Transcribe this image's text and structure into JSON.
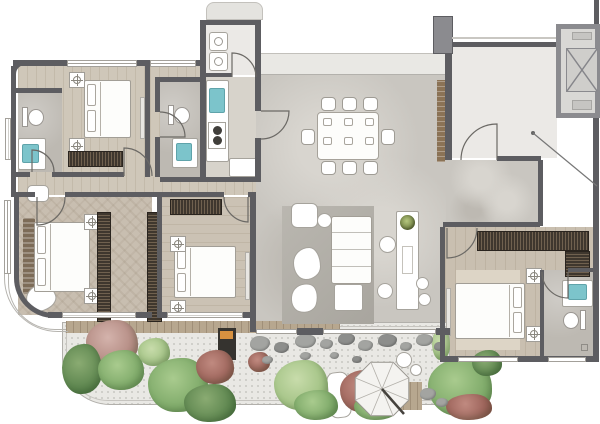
{
  "meta": {
    "title": "Apartment floor plan rendering",
    "canvas_w": 600,
    "canvas_h": 424
  },
  "palette": {
    "wall": "#5d5d61",
    "wallMid": "#8b8b8f",
    "outline": "#a5a29b",
    "marble": "#c9c6c0",
    "marbleLight": "#d8d5cf",
    "bath": "#bdb9b2",
    "lobby": "#ebe9e6",
    "band": "#e9e8e4",
    "wood": "#cfc7b9",
    "woodV": "#cbc2b4",
    "herringbone": "#c8beb0",
    "woodBed4": "#c9bfb0",
    "deck": "#b7a78f",
    "gravel": "#e9e8e4",
    "rug": "#b3b0a9",
    "rugBeige": "#ddd5c6",
    "white": "#ffffff",
    "blue": "#7cc4cb",
    "orange": "#d79140",
    "bbq": "#35332f",
    "wardrobe": "#3f372e",
    "wardrobeSlat": "#70614f",
    "headboard": "#7d6c58",
    "brick": "#8b7356",
    "stone": "#a3a4a1",
    "stoneDark": "#8d8e8c"
  },
  "treeColors": {
    "green": [
      "#a9cb8e",
      "#6f9e5c"
    ],
    "greenL": [
      "#c8dcab",
      "#95b977"
    ],
    "greenD": [
      "#8aab72",
      "#4f7a44"
    ],
    "red": [
      "#c08a80",
      "#91574e"
    ],
    "pink": [
      "#d4b3ac",
      "#a87d74"
    ]
  },
  "rooms": [
    {
      "id": "bathroom-1",
      "label": "Bathroom 1"
    },
    {
      "id": "bedroom-1",
      "label": "Bedroom 1"
    },
    {
      "id": "hallway",
      "label": "Hallway"
    },
    {
      "id": "bathroom-2",
      "label": "Bathroom 2"
    },
    {
      "id": "utility-room",
      "label": "Utility / Laundry"
    },
    {
      "id": "kitchen",
      "label": "Kitchen"
    },
    {
      "id": "dining-area",
      "label": "Dining Area"
    },
    {
      "id": "living-room",
      "label": "Living Room"
    },
    {
      "id": "master-bedroom",
      "label": "Master Bedroom"
    },
    {
      "id": "bedroom-3",
      "label": "Bedroom 3"
    },
    {
      "id": "bedroom-4",
      "label": "Bedroom 4"
    },
    {
      "id": "ensuite-bathroom",
      "label": "Ensuite Bathroom"
    },
    {
      "id": "entry-lobby",
      "label": "Entry Lobby"
    },
    {
      "id": "elevator",
      "label": "Elevator"
    },
    {
      "id": "balcony-garden",
      "label": "Balcony Garden"
    }
  ],
  "beds": [
    {
      "x": 84,
      "y": 80,
      "w": 47,
      "h": 58,
      "head": "left"
    },
    {
      "x": 34,
      "y": 222,
      "w": 56,
      "h": 70,
      "head": "left"
    },
    {
      "x": 174,
      "y": 246,
      "w": 62,
      "h": 52,
      "head": "left"
    },
    {
      "x": 455,
      "y": 283,
      "w": 70,
      "h": 56,
      "head": "right"
    }
  ],
  "lamps": [
    [
      69,
      72
    ],
    [
      69,
      138
    ],
    [
      84,
      214
    ],
    [
      84,
      288
    ],
    [
      170,
      236
    ],
    [
      170,
      300
    ],
    [
      526,
      268
    ],
    [
      526,
      326
    ]
  ],
  "wardrobes": [
    {
      "x": 68,
      "y": 151,
      "w": 55,
      "h": 16,
      "dir": "v"
    },
    {
      "x": 97,
      "y": 212,
      "w": 14,
      "h": 110,
      "dir": "h"
    },
    {
      "x": 147,
      "y": 212,
      "w": 15,
      "h": 110,
      "dir": "h"
    },
    {
      "x": 170,
      "y": 199,
      "w": 52,
      "h": 16,
      "dir": "v"
    },
    {
      "x": 477,
      "y": 231,
      "w": 112,
      "h": 20,
      "dir": "v"
    },
    {
      "x": 565,
      "y": 251,
      "w": 25,
      "h": 26,
      "dir": "h"
    }
  ],
  "dining": {
    "table": {
      "x": 317,
      "y": 112,
      "w": 62,
      "h": 48
    },
    "chairs": [
      [
        321,
        97,
        15,
        14
      ],
      [
        342,
        97,
        15,
        14
      ],
      [
        363,
        97,
        15,
        14
      ],
      [
        321,
        161,
        15,
        14
      ],
      [
        342,
        161,
        15,
        14
      ],
      [
        363,
        161,
        15,
        14
      ],
      [
        301,
        129,
        14,
        16
      ],
      [
        381,
        129,
        14,
        16
      ]
    ],
    "plates": [
      [
        323,
        118
      ],
      [
        344,
        118
      ],
      [
        365,
        118
      ],
      [
        323,
        137
      ],
      [
        344,
        137
      ],
      [
        365,
        137
      ]
    ]
  },
  "garden": {
    "trees": [
      {
        "x": 86,
        "y": 320,
        "w": 52,
        "h": 46,
        "c": "pink"
      },
      {
        "x": 62,
        "y": 344,
        "w": 40,
        "h": 50,
        "c": "greenD"
      },
      {
        "x": 98,
        "y": 350,
        "w": 46,
        "h": 40,
        "c": "green"
      },
      {
        "x": 138,
        "y": 338,
        "w": 32,
        "h": 28,
        "c": "greenL"
      },
      {
        "x": 148,
        "y": 358,
        "w": 60,
        "h": 54,
        "c": "green"
      },
      {
        "x": 196,
        "y": 350,
        "w": 38,
        "h": 34,
        "c": "red"
      },
      {
        "x": 184,
        "y": 384,
        "w": 52,
        "h": 38,
        "c": "greenD"
      },
      {
        "x": 274,
        "y": 360,
        "w": 54,
        "h": 50,
        "c": "greenL"
      },
      {
        "x": 294,
        "y": 390,
        "w": 44,
        "h": 30,
        "c": "green"
      },
      {
        "x": 248,
        "y": 352,
        "w": 22,
        "h": 20,
        "c": "red"
      },
      {
        "x": 340,
        "y": 370,
        "w": 44,
        "h": 42,
        "c": "red"
      },
      {
        "x": 354,
        "y": 394,
        "w": 44,
        "h": 26,
        "c": "green"
      },
      {
        "x": 432,
        "y": 328,
        "w": 18,
        "h": 32,
        "c": "greenL"
      },
      {
        "x": 428,
        "y": 358,
        "w": 64,
        "h": 58,
        "c": "green"
      },
      {
        "x": 446,
        "y": 394,
        "w": 46,
        "h": 26,
        "c": "red"
      },
      {
        "x": 472,
        "y": 350,
        "w": 30,
        "h": 26,
        "c": "greenD"
      }
    ],
    "stones": [
      [
        250,
        336,
        20,
        15
      ],
      [
        274,
        342,
        15,
        11
      ],
      [
        295,
        334,
        21,
        14
      ],
      [
        320,
        339,
        13,
        10
      ],
      [
        338,
        333,
        17,
        12
      ],
      [
        300,
        352,
        11,
        8
      ],
      [
        358,
        340,
        15,
        11
      ],
      [
        378,
        334,
        19,
        13
      ],
      [
        400,
        342,
        12,
        9
      ],
      [
        416,
        334,
        17,
        12
      ],
      [
        434,
        342,
        11,
        9
      ],
      [
        262,
        356,
        11,
        8
      ],
      [
        330,
        352,
        9,
        7
      ],
      [
        352,
        356,
        10,
        7
      ],
      [
        420,
        388,
        16,
        12
      ],
      [
        436,
        398,
        12,
        9
      ]
    ],
    "umbrella": {
      "cx": 382,
      "cy": 389,
      "r": 29
    }
  },
  "annotation": {
    "dot": [
      533,
      133
    ],
    "end": [
      597,
      186
    ]
  }
}
